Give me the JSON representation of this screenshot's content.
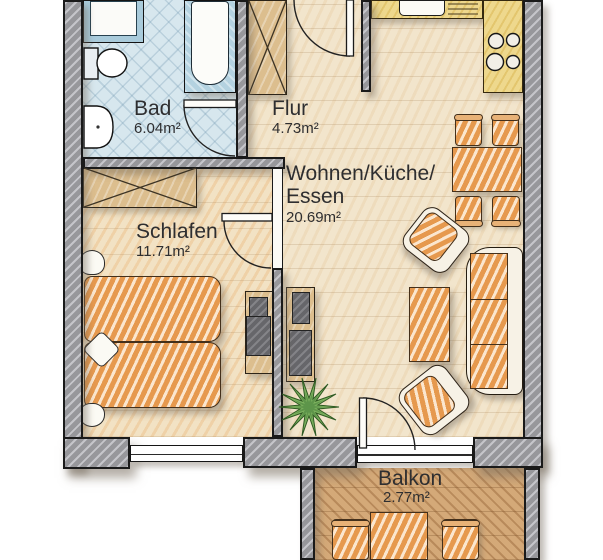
{
  "rooms": {
    "bad": {
      "name": "Bad",
      "area": "6.04m²"
    },
    "flur": {
      "name": "Flur",
      "area": "4.73m²"
    },
    "wohnen": {
      "name_line1": "Wohnen/Küche/",
      "name_line2": "Essen",
      "area": "20.69m²"
    },
    "schlafen": {
      "name": "Schlafen",
      "area": "11.71m²"
    },
    "balkon": {
      "name": "Balkon",
      "area": "2.77m²"
    }
  },
  "colors": {
    "wall_gray": "#97979b",
    "bath_floor_blue": "#d7e7ee",
    "hall_living_floor": "#f2e5cc",
    "bedroom_floor": "#f2e2c4",
    "balcony_floor": "#d4a978",
    "furniture_orange": "#e6994e",
    "kitchen_yellow": "#eed88d",
    "wood_tan": "#dcbe8e",
    "cabinet_dark_gray": "#66666a",
    "plant_green": "#7cb15e",
    "label_text": "#2e2e30"
  },
  "furniture_icons": [
    "shower",
    "bathtub",
    "toilet",
    "washbasin",
    "hall-wardrobe",
    "entrance-door-swing",
    "bath-door-swing",
    "bedroom-door-swing",
    "balcony-door-swing",
    "kitchen-counter",
    "kitchen-sink",
    "stove-hob",
    "dining-table",
    "dining-chair",
    "armchair",
    "sofa",
    "coffee-table",
    "tv-cabinet",
    "bedroom-wardrobe",
    "double-bed",
    "pillow",
    "plant",
    "balcony-table",
    "balcony-chair",
    "window"
  ]
}
